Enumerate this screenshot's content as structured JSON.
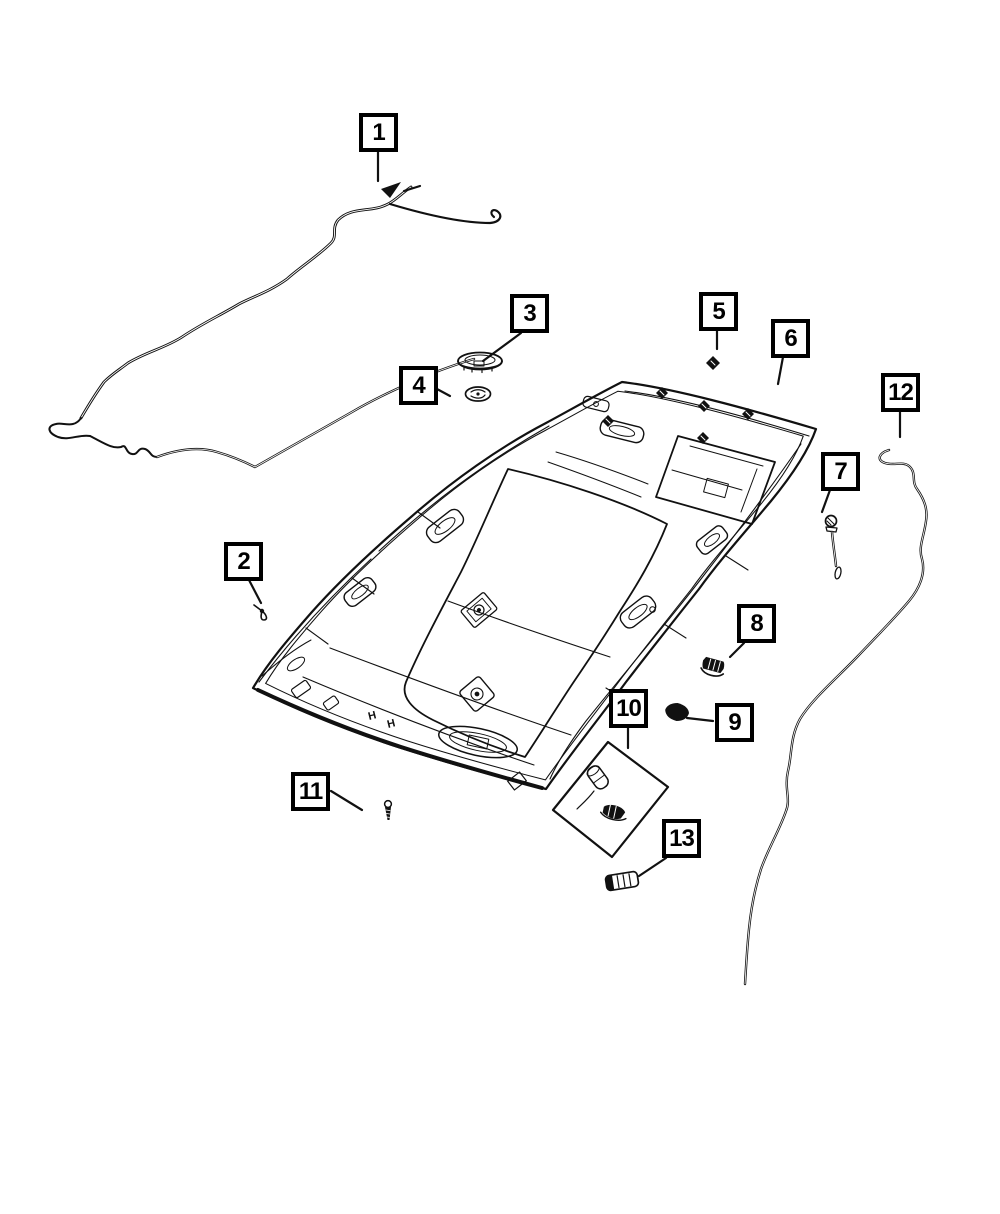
{
  "diagram": {
    "description": "Exploded parts diagram of a vehicle headliner and overhead trim with numbered callouts",
    "colors": {
      "background": "#ffffff",
      "line": "#111111",
      "callout_border": "#000000",
      "callout_background": "#ffffff",
      "callout_text": "#000000"
    },
    "callouts": [
      {
        "label": "1",
        "part_icon": "antenna-cable-icon"
      },
      {
        "label": "2",
        "part_icon": "retainer-clip-icon"
      },
      {
        "label": "3",
        "part_icon": "dome-lamp-lens-icon"
      },
      {
        "label": "4",
        "part_icon": "round-retainer-icon"
      },
      {
        "label": "5",
        "part_icon": "push-clip-icon"
      },
      {
        "label": "6",
        "part_icon": "headliner-panel-icon"
      },
      {
        "label": "7",
        "part_icon": "push-pin-icon"
      },
      {
        "label": "8",
        "part_icon": "hook-bracket-icon"
      },
      {
        "label": "9",
        "part_icon": "pad-clip-icon"
      },
      {
        "label": "10",
        "part_icon": "bulb-and-socket-kit-icon"
      },
      {
        "label": "11",
        "part_icon": "screw-icon"
      },
      {
        "label": "12",
        "part_icon": "side-wire-icon"
      },
      {
        "label": "13",
        "part_icon": "lamp-lens-icon"
      }
    ],
    "h_marks": [
      "H",
      "H"
    ]
  }
}
